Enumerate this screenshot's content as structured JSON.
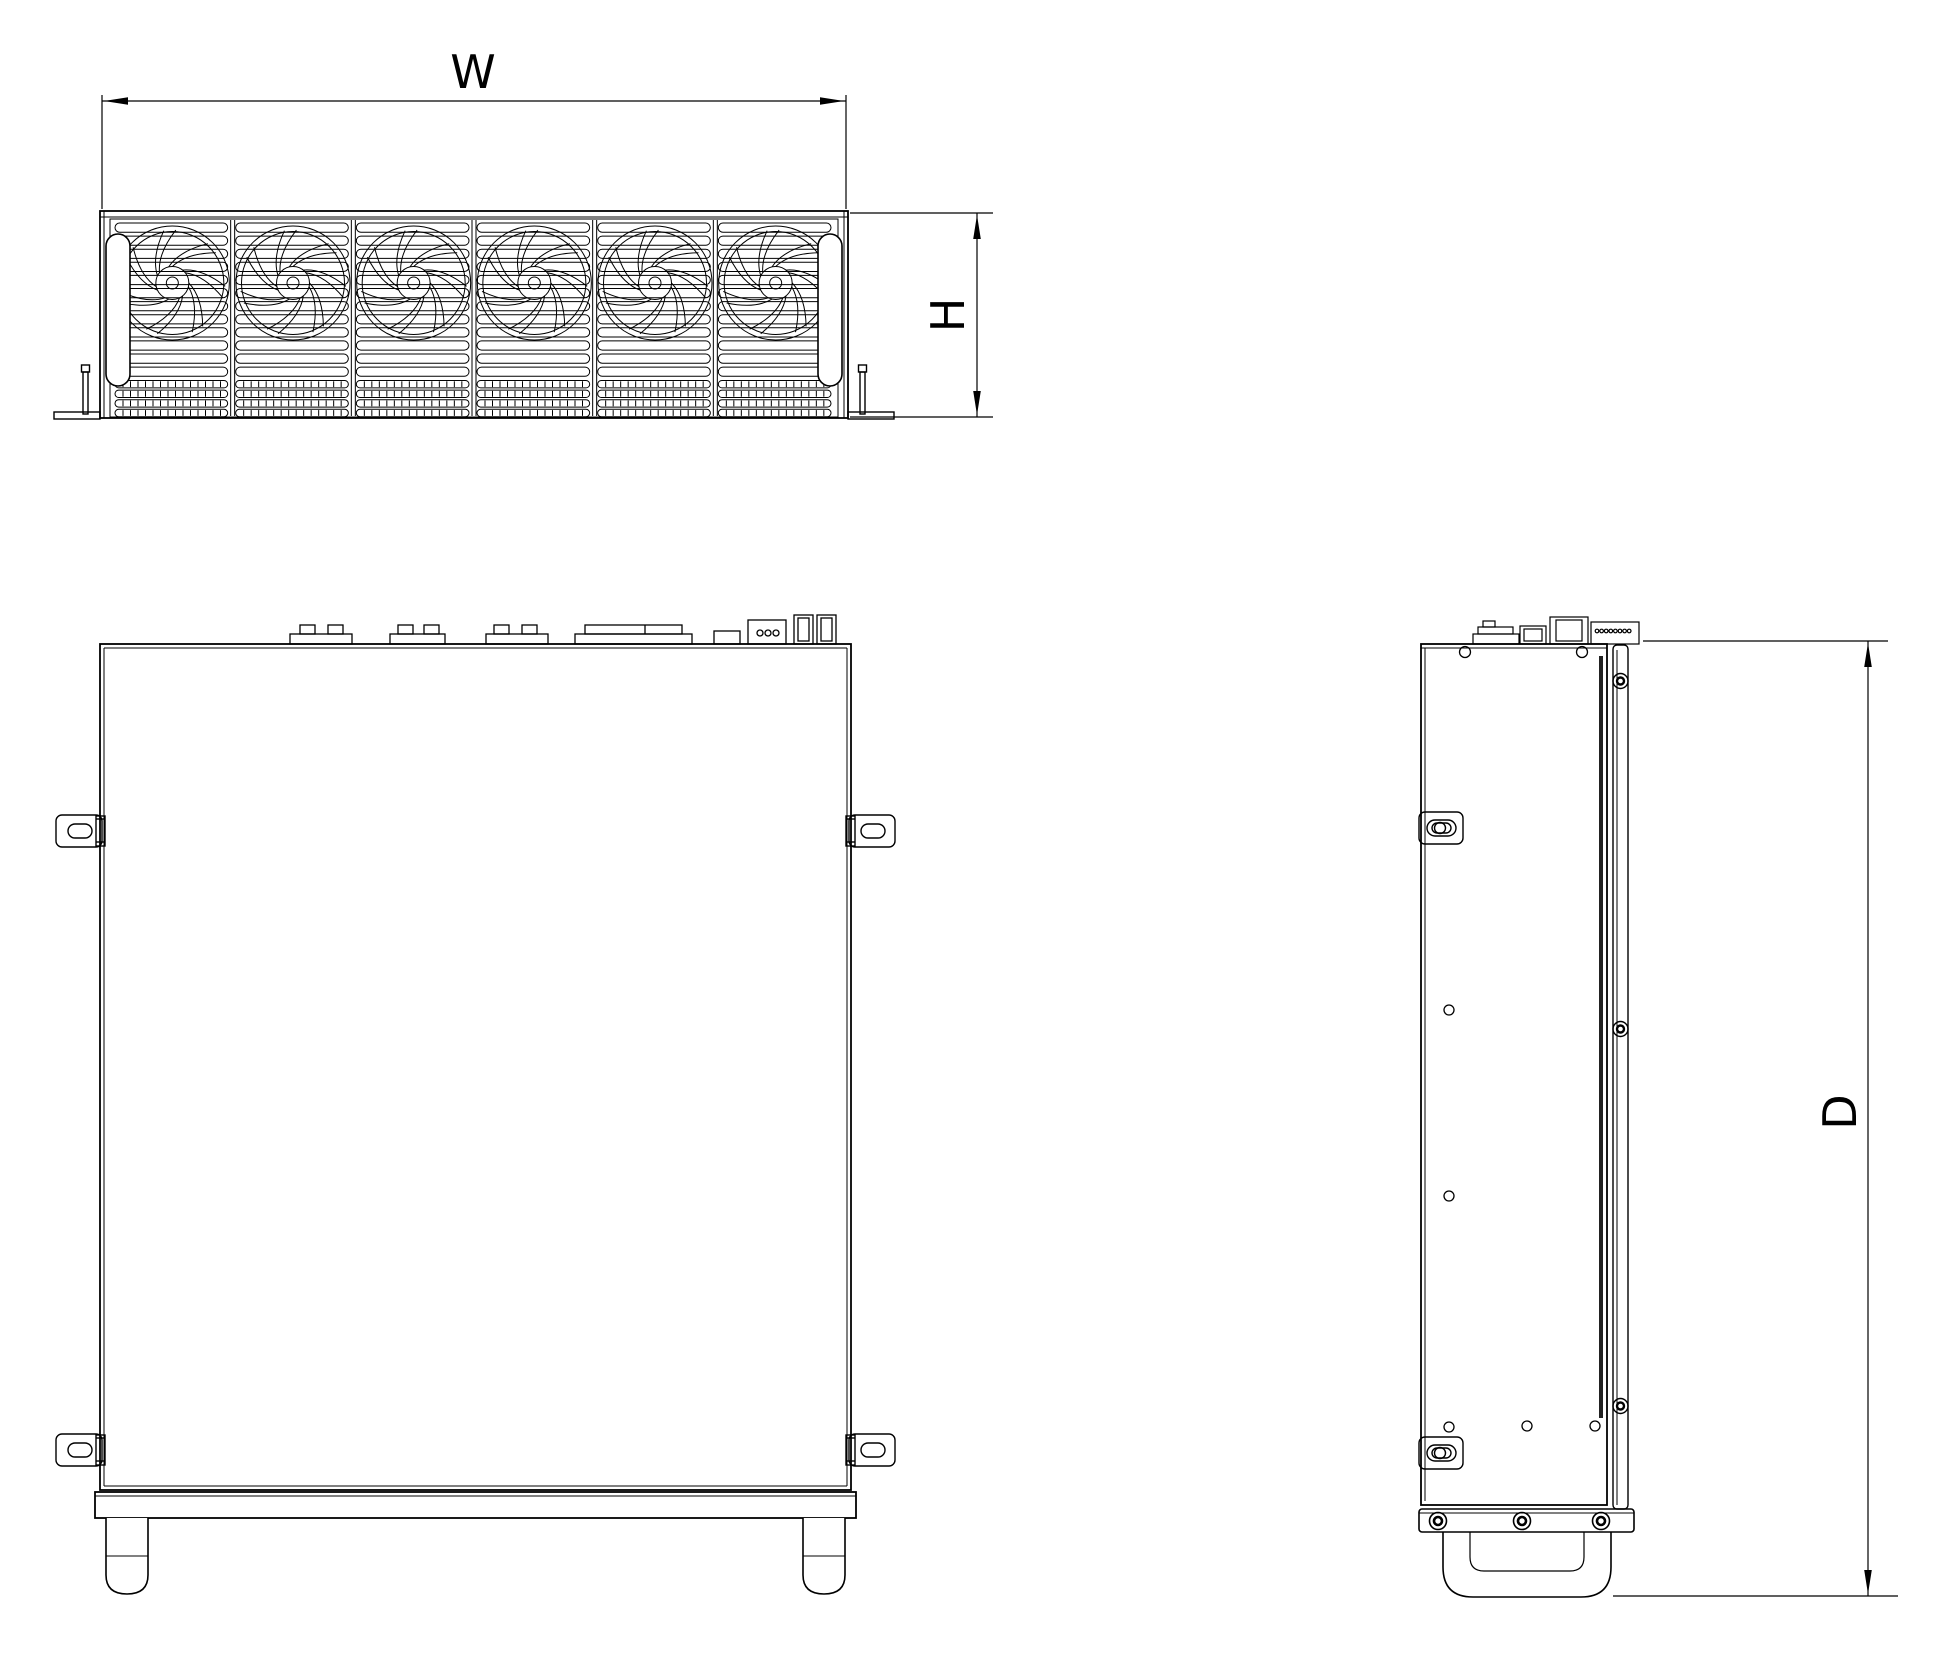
{
  "drawing": {
    "type": "engineering-three-view",
    "dimensions": {
      "width_label": "W",
      "height_label": "H",
      "depth_label": "D"
    },
    "views": {
      "front": "front-view-with-fans",
      "top": "top-view",
      "side": "side-view"
    },
    "front_view": {
      "fan_count": 6,
      "grille_slot_rows": 12,
      "vent_tick_rows": 4
    },
    "colors": {
      "line": "#000000",
      "background": "#ffffff",
      "shadow_strip": "#222222"
    }
  }
}
